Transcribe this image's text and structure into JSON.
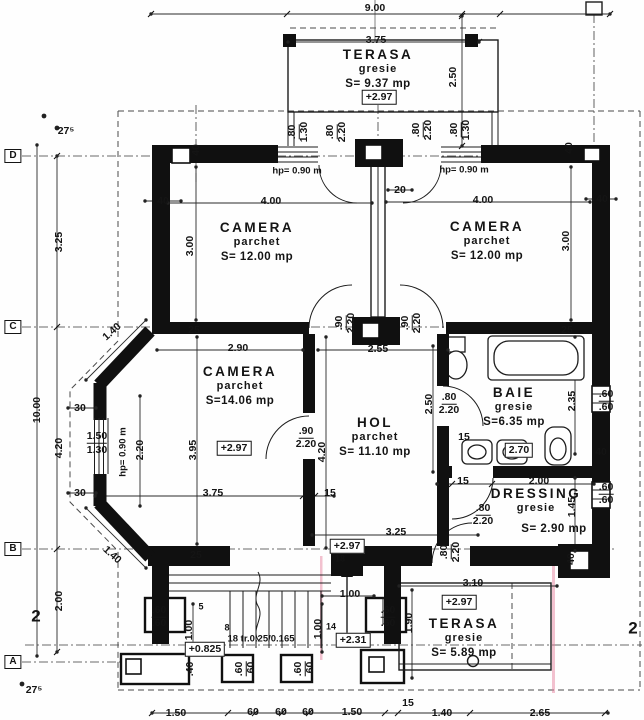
{
  "palette": {
    "paper": "#fefefe",
    "ink": "#141414",
    "wall": "#101010",
    "scan_artifact_pink": "#e478a0"
  },
  "rooms": {
    "terasa_top": {
      "name": "TERASA",
      "finish": "gresie",
      "area": "S= 9.37 mp"
    },
    "camera_tl": {
      "name": "CAMERA",
      "finish": "parchet",
      "area": "S= 12.00 mp"
    },
    "camera_tr": {
      "name": "CAMERA",
      "finish": "parchet",
      "area": "S= 12.00 mp"
    },
    "camera_mid": {
      "name": "CAMERA",
      "finish": "parchet",
      "area": "S=14.06 mp"
    },
    "hol": {
      "name": "HOL",
      "finish": "parchet",
      "area": "S= 11.10 mp"
    },
    "baie": {
      "name": "BAIE",
      "finish": "gresie",
      "area": "S=6.35 mp"
    },
    "dressing": {
      "name": "DRESSING",
      "finish": "gresie",
      "area": "S= 2.90 mp"
    },
    "terasa_bottom": {
      "name": "TERASA",
      "finish": "gresie",
      "area": "S= 5.89 mp"
    }
  },
  "labels": [
    {
      "t": "9.00",
      "x": 375,
      "y": 8
    },
    {
      "t": "3.75",
      "x": 376,
      "y": 40
    },
    {
      "t": "2.50",
      "x": 453,
      "y": 77,
      "r": -90
    },
    {
      "t": "+2.97",
      "x": 379,
      "y": 97,
      "c": "box",
      "n": "elevation-label"
    },
    {
      "t": "27⁵",
      "x": 66,
      "y": 131
    },
    {
      "t": "D",
      "x": 13,
      "y": 156,
      "c": "axis",
      "n": "axis-row-d"
    },
    {
      "t": "3.25",
      "x": 59,
      "y": 242,
      "r": -90
    },
    {
      "t": "C",
      "x": 13,
      "y": 327,
      "c": "axis",
      "n": "axis-row-c"
    },
    {
      "t": "10.00",
      "x": 37,
      "y": 410,
      "r": -90
    },
    {
      "t": "4.20",
      "x": 59,
      "y": 448,
      "r": -90
    },
    {
      "t": "B",
      "x": 13,
      "y": 549,
      "c": "axis",
      "n": "axis-row-b"
    },
    {
      "t": "2.00",
      "x": 59,
      "y": 601,
      "r": -90
    },
    {
      "t": "2",
      "x": 36,
      "y": 616,
      "c": "big",
      "n": "axis-col-2"
    },
    {
      "t": "A",
      "x": 13,
      "y": 662,
      "c": "axis",
      "n": "axis-row-a"
    },
    {
      "t": "27⁵",
      "x": 34,
      "y": 690
    },
    {
      "t": ".80",
      "x": 293,
      "y": 132,
      "r": -90,
      "c": "fu2"
    },
    {
      "t": "1.30",
      "x": 304,
      "y": 132,
      "r": -90
    },
    {
      "t": ".80",
      "x": 331,
      "y": 132,
      "r": -90,
      "c": "fu2"
    },
    {
      "t": "2.20",
      "x": 342,
      "y": 132,
      "r": -90
    },
    {
      "t": ".80",
      "x": 417,
      "y": 130,
      "r": -90,
      "c": "fu2"
    },
    {
      "t": "2.20",
      "x": 428,
      "y": 130,
      "r": -90
    },
    {
      "t": ".80",
      "x": 455,
      "y": 130,
      "r": -90,
      "c": "fu2"
    },
    {
      "t": "1.30",
      "x": 466,
      "y": 130,
      "r": -90
    },
    {
      "t": "hp= 0.90 m",
      "x": 297,
      "y": 171,
      "c": "note",
      "n": "window-sill-note"
    },
    {
      "t": "hp= 0.90 m",
      "x": 464,
      "y": 170,
      "c": "note",
      "n": "window-sill-note"
    },
    {
      "t": "40",
      "x": 196,
      "y": 150,
      "r": -90
    },
    {
      "t": "40",
      "x": 569,
      "y": 148,
      "r": -90
    },
    {
      "t": "40",
      "x": 163,
      "y": 201
    },
    {
      "t": "40",
      "x": 602,
      "y": 199
    },
    {
      "t": "20",
      "x": 400,
      "y": 190
    },
    {
      "t": "4.00",
      "x": 271,
      "y": 201
    },
    {
      "t": "4.00",
      "x": 483,
      "y": 200
    },
    {
      "t": "3.00",
      "x": 190,
      "y": 246,
      "r": -90
    },
    {
      "t": "3.00",
      "x": 566,
      "y": 241,
      "r": -90
    },
    {
      "t": "25",
      "x": 194,
      "y": 330
    },
    {
      "t": "25",
      "x": 567,
      "y": 330
    },
    {
      "t": "2.55",
      "x": 378,
      "y": 349
    },
    {
      "t": ".90",
      "x": 340,
      "y": 323,
      "r": -90,
      "c": "fu2"
    },
    {
      "t": "2.20",
      "x": 351,
      "y": 323,
      "r": -90
    },
    {
      "t": ".90",
      "x": 406,
      "y": 323,
      "r": -90,
      "c": "fu2"
    },
    {
      "t": "2.20",
      "x": 417,
      "y": 323,
      "r": -90
    },
    {
      "t": "2.90",
      "x": 238,
      "y": 348
    },
    {
      "t": "1.40",
      "x": 112,
      "y": 332,
      "r": -42
    },
    {
      "t": "+2.97",
      "x": 234,
      "y": 448,
      "c": "box",
      "n": "elevation-label"
    },
    {
      "t": "30",
      "x": 80,
      "y": 408
    },
    {
      "t": "30",
      "x": 80,
      "y": 493
    },
    {
      "t": "1.50",
      "x": 97,
      "y": 437,
      "c": "fu2"
    },
    {
      "t": "1.30",
      "x": 97,
      "y": 450
    },
    {
      "t": "hp= 0.90 m",
      "x": 123,
      "y": 452,
      "r": -90,
      "c": "note",
      "n": "window-sill-note"
    },
    {
      "t": "2.20",
      "x": 140,
      "y": 450,
      "r": -90
    },
    {
      "t": "3.95",
      "x": 193,
      "y": 450,
      "r": -90
    },
    {
      "t": ".90",
      "x": 306,
      "y": 432,
      "c": "fu2"
    },
    {
      "t": "2.20",
      "x": 306,
      "y": 444
    },
    {
      "t": "4.20",
      "x": 322,
      "y": 452,
      "r": -90
    },
    {
      "t": "3.75",
      "x": 213,
      "y": 493
    },
    {
      "t": "15",
      "x": 330,
      "y": 493
    },
    {
      "t": "2.50",
      "x": 429,
      "y": 404,
      "r": -90
    },
    {
      "t": ".80",
      "x": 449,
      "y": 398,
      "c": "fu2"
    },
    {
      "t": "2.20",
      "x": 449,
      "y": 410
    },
    {
      "t": "15",
      "x": 464,
      "y": 437
    },
    {
      "t": "2.70",
      "x": 519,
      "y": 450,
      "c": "box"
    },
    {
      "t": "2.35",
      "x": 572,
      "y": 401,
      "r": -90
    },
    {
      "t": ".60",
      "x": 606,
      "y": 395,
      "c": "fu2"
    },
    {
      "t": ".60",
      "x": 606,
      "y": 407
    },
    {
      "t": "40",
      "x": 601,
      "y": 452
    },
    {
      "t": "15",
      "x": 463,
      "y": 481
    },
    {
      "t": "2.00",
      "x": 539,
      "y": 481
    },
    {
      "t": "1.45",
      "x": 572,
      "y": 507,
      "r": -90
    },
    {
      "t": ".80",
      "x": 483,
      "y": 509,
      "c": "fu2"
    },
    {
      "t": "2.20",
      "x": 483,
      "y": 521
    },
    {
      "t": ".60",
      "x": 606,
      "y": 488,
      "c": "fu2"
    },
    {
      "t": ".60",
      "x": 606,
      "y": 500
    },
    {
      "t": ".80",
      "x": 445,
      "y": 552,
      "r": -90,
      "c": "fu2"
    },
    {
      "t": "2.20",
      "x": 456,
      "y": 552,
      "r": -90
    },
    {
      "t": "40",
      "x": 571,
      "y": 559,
      "r": -90
    },
    {
      "t": "3.25",
      "x": 396,
      "y": 532
    },
    {
      "t": "1.40",
      "x": 112,
      "y": 555,
      "r": 42
    },
    {
      "t": "25",
      "x": 196,
      "y": 555
    },
    {
      "t": "+2.97",
      "x": 347,
      "y": 546,
      "c": "box",
      "n": "elevation-label"
    },
    {
      "t": "18",
      "x": 340,
      "y": 559,
      "c": "small"
    },
    {
      "t": "1.00",
      "x": 350,
      "y": 594
    },
    {
      "t": "5",
      "x": 201,
      "y": 607,
      "c": "small"
    },
    {
      "t": "8",
      "x": 227,
      "y": 628,
      "c": "small"
    },
    {
      "t": "1.00",
      "x": 189,
      "y": 630,
      "r": -90
    },
    {
      "t": "18 tr.0.25/0.165",
      "x": 261,
      "y": 639,
      "c": "note",
      "n": "stair-note"
    },
    {
      "t": "1.00",
      "x": 318,
      "y": 629,
      "r": -90
    },
    {
      "t": "14",
      "x": 331,
      "y": 627,
      "c": "small"
    },
    {
      "t": "+2.31",
      "x": 353,
      "y": 640,
      "c": "box",
      "n": "elevation-label"
    },
    {
      "t": "+0.825",
      "x": 205,
      "y": 649,
      "c": "box",
      "n": "elevation-label"
    },
    {
      "t": ".60",
      "x": 159,
      "y": 611,
      "c": "fu2"
    },
    {
      "t": ".60",
      "x": 159,
      "y": 623
    },
    {
      "t": ".60",
      "x": 388,
      "y": 611,
      "c": "fu2"
    },
    {
      "t": ".60",
      "x": 388,
      "y": 623
    },
    {
      "t": ".40",
      "x": 190,
      "y": 669,
      "r": -90
    },
    {
      "t": ".60",
      "x": 240,
      "y": 669,
      "r": -90,
      "c": "fu2"
    },
    {
      "t": ".60",
      "x": 251,
      "y": 669,
      "r": -90
    },
    {
      "t": ".60",
      "x": 299,
      "y": 669,
      "r": -90,
      "c": "fu2"
    },
    {
      "t": ".60",
      "x": 310,
      "y": 669,
      "r": -90
    },
    {
      "t": "3.10",
      "x": 473,
      "y": 583
    },
    {
      "t": "+2.97",
      "x": 459,
      "y": 602,
      "c": "box",
      "n": "elevation-label"
    },
    {
      "t": "1.90",
      "x": 409,
      "y": 623,
      "r": -90
    },
    {
      "t": "2",
      "x": 633,
      "y": 628,
      "c": "big",
      "n": "axis-col-2"
    },
    {
      "t": "1.50",
      "x": 176,
      "y": 713
    },
    {
      "t": "60",
      "x": 253,
      "y": 712
    },
    {
      "t": "60",
      "x": 281,
      "y": 712
    },
    {
      "t": "60",
      "x": 308,
      "y": 712
    },
    {
      "t": "1.50",
      "x": 352,
      "y": 712
    },
    {
      "t": "15",
      "x": 408,
      "y": 703
    },
    {
      "t": "1.40",
      "x": 442,
      "y": 713
    },
    {
      "t": "2.65",
      "x": 540,
      "y": 713
    }
  ]
}
